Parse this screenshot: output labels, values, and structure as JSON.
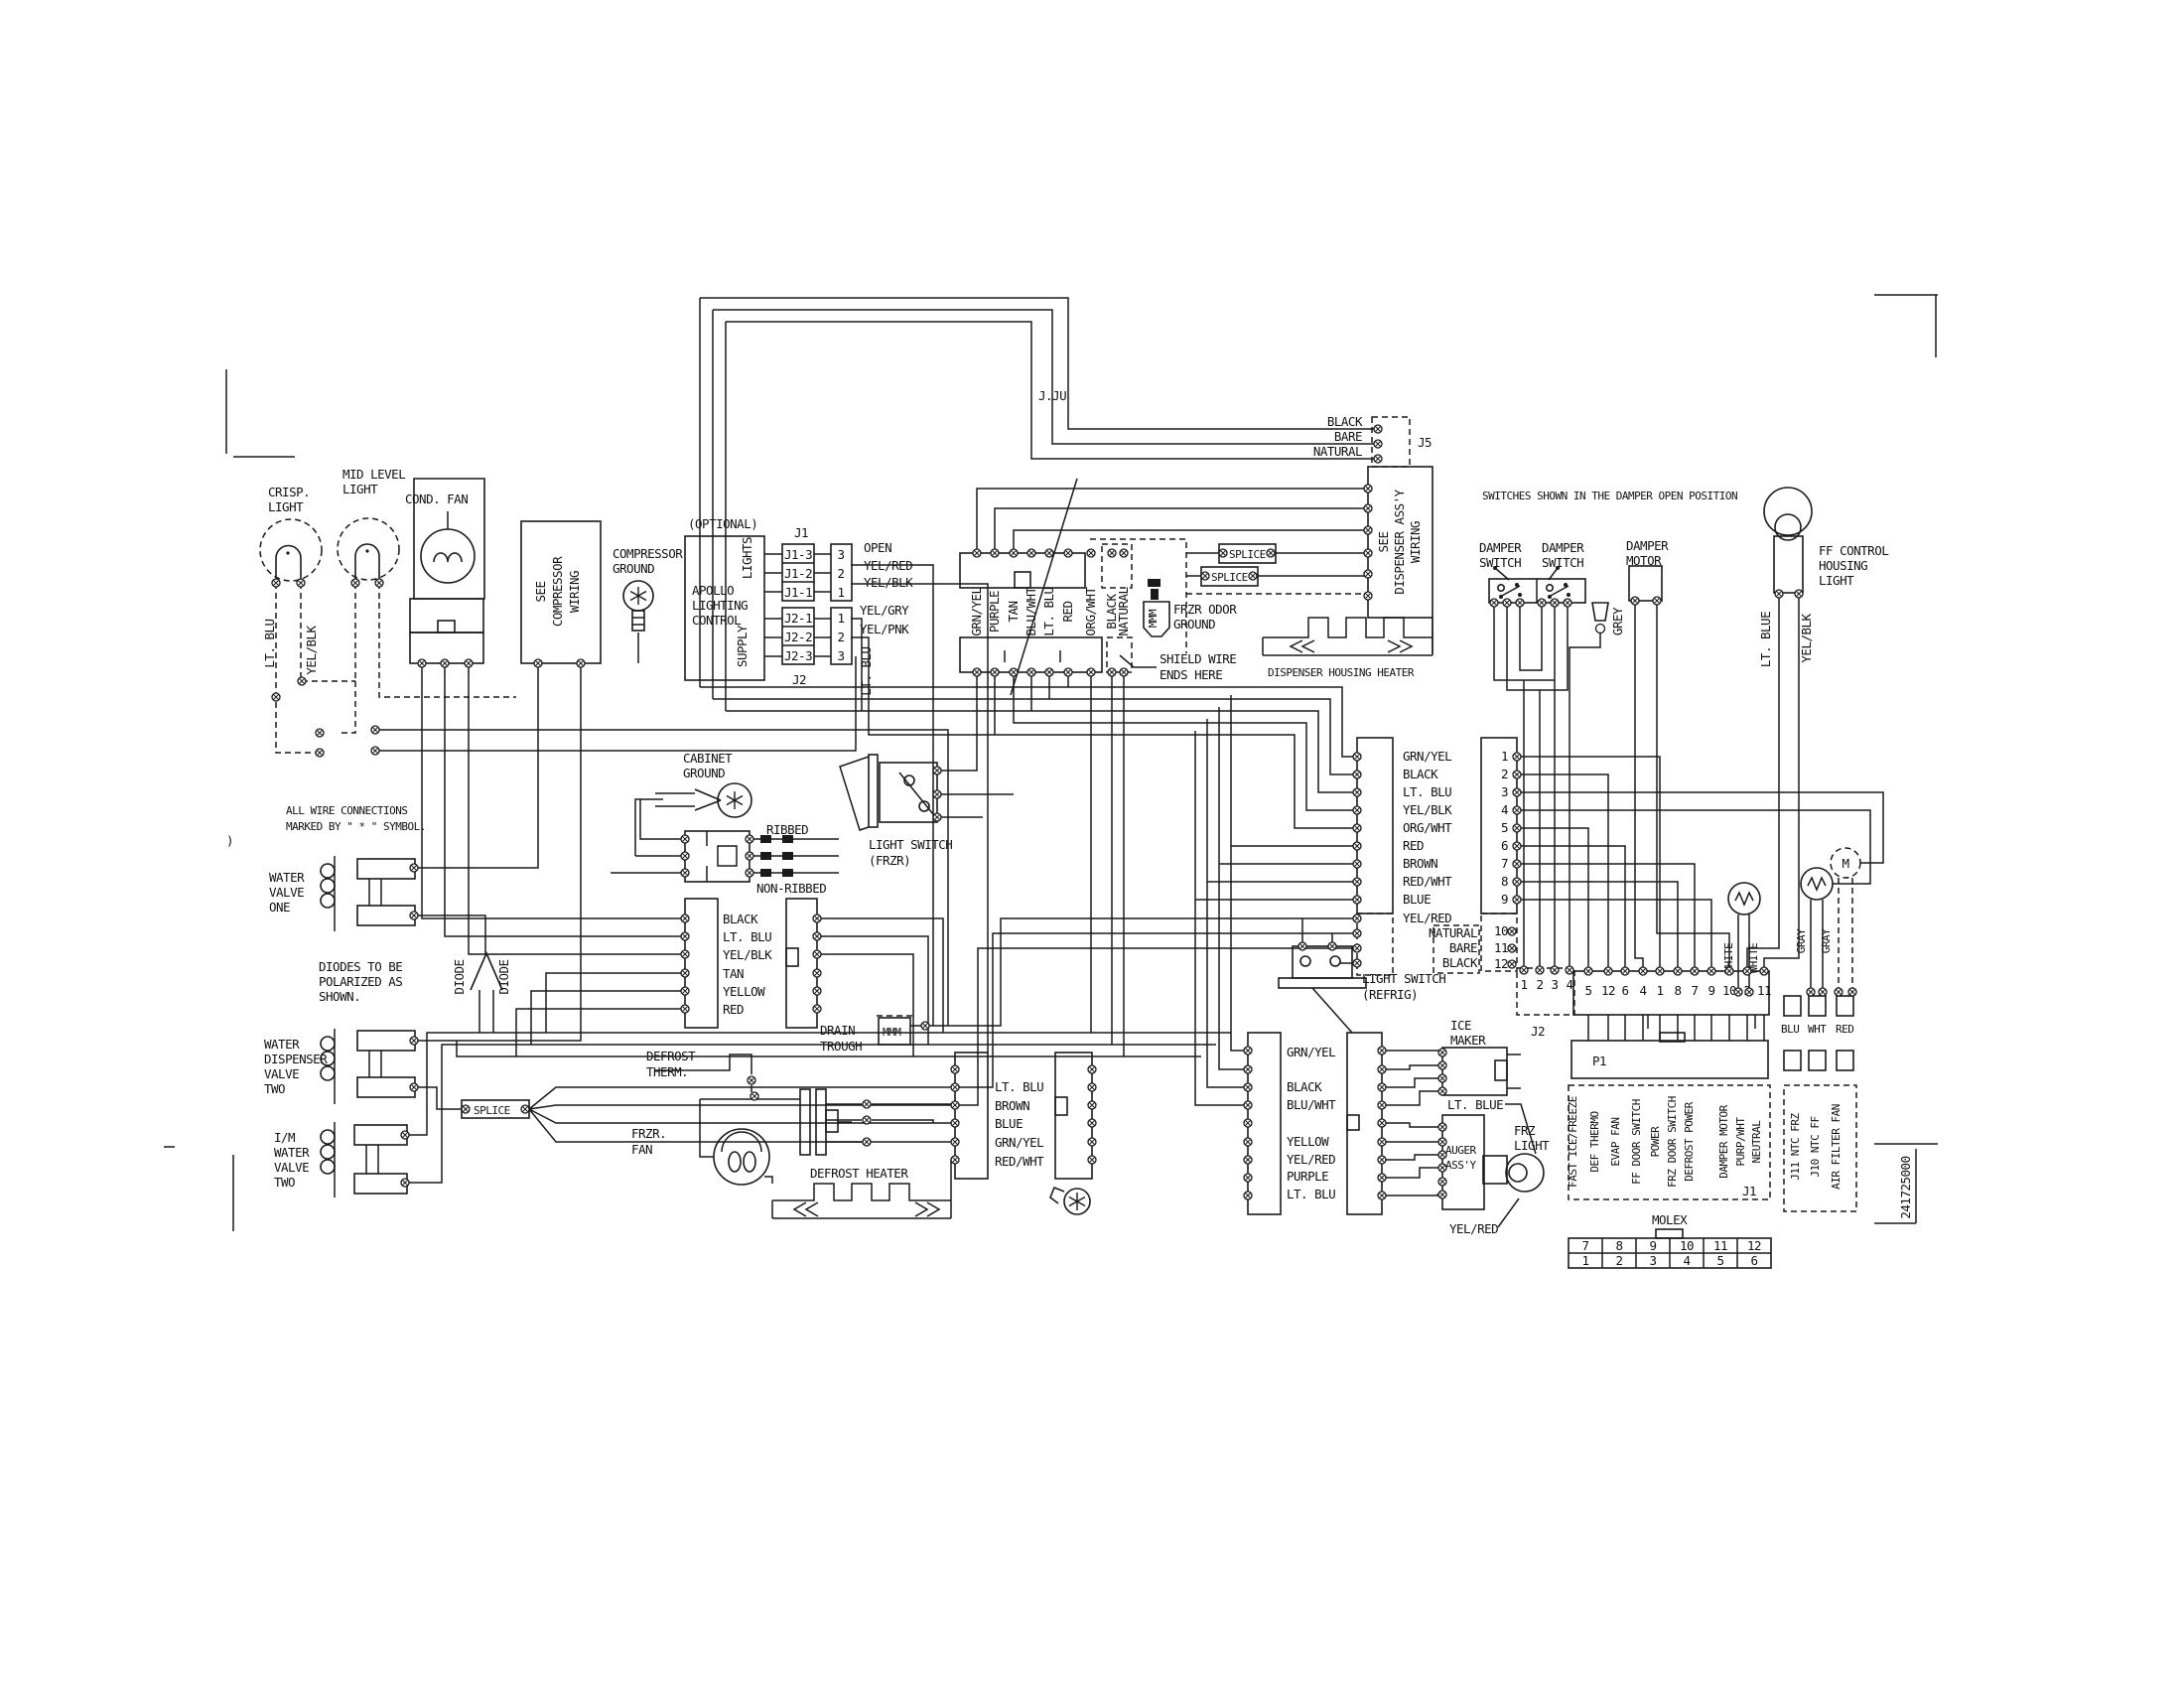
{
  "diagram": {
    "part_number": "241725000",
    "artifact_text": "J.JU",
    "paren": ")",
    "notes": {
      "all_wire_1": "ALL WIRE CONNECTIONS",
      "all_wire_2": "MARKED BY \" * \" SYMBOL.",
      "diodes_1": "DIODES TO BE",
      "diodes_2": "POLARIZED AS",
      "diodes_3": "SHOWN.",
      "switches": "SWITCHES SHOWN IN THE DAMPER OPEN POSITION",
      "shield_1": "SHIELD WIRE",
      "shield_2": "ENDS HERE"
    },
    "components": {
      "crisp_light_1": "CRISP.",
      "crisp_light_2": "LIGHT",
      "mid_level_1": "MID LEVEL",
      "mid_level_2": "LIGHT",
      "cond_fan": "COND. FAN",
      "see_comp_1": "SEE",
      "see_comp_2": "COMPRESSOR",
      "see_comp_3": "WIRING",
      "comp_gnd_1": "COMPRESSOR",
      "comp_gnd_2": "GROUND",
      "optional": "(OPTIONAL)",
      "apollo_1": "APOLLO",
      "apollo_2": "LIGHTING",
      "apollo_3": "CONTROL",
      "lights": "LIGHTS",
      "supply": "SUPPLY",
      "j1": "J1",
      "j2": "J2",
      "cabinet_gnd_1": "CABINET",
      "cabinet_gnd_2": "GROUND",
      "ribbed": "RIBBED",
      "non_ribbed": "NON-RIBBED",
      "ls_frzr_1": "LIGHT SWITCH",
      "ls_frzr_2": "(FRZR)",
      "drain_1": "DRAIN",
      "drain_2": "TROUGH",
      "def_therm_1": "DEFROST",
      "def_therm_2": "THERM.",
      "frzr_fan_1": "FRZR.",
      "frzr_fan_2": "FAN",
      "defrost_heater": "DEFROST HEATER",
      "frzr_odor_1": "FRZR ODOR",
      "frzr_odor_2": "GROUND",
      "mmm": "MMM",
      "water_valve_one_1": "WATER",
      "water_valve_one_2": "VALVE",
      "water_valve_one_3": "ONE",
      "wd_valve_1": "WATER",
      "wd_valve_2": "DISPENSER",
      "wd_valve_3": "VALVE",
      "wd_valve_4": "TWO",
      "im_valve_1": "I/M",
      "im_valve_2": "WATER",
      "im_valve_3": "VALVE",
      "im_valve_4": "TWO",
      "diode": "DIODE",
      "splice": "SPLICE",
      "j5": "J5",
      "see_disp_1": "SEE",
      "see_disp_2": "DISPENSER ASS'Y",
      "see_disp_3": "WIRING",
      "disp_heater": "DISPENSER HOUSING HEATER",
      "damper_sw_1": "DAMPER",
      "damper_sw_2": "SWITCH",
      "damper_mot_1": "DAMPER",
      "damper_mot_2": "MOTOR",
      "grey": "GREY",
      "ff_light_1": "FF CONTROL",
      "ff_light_2": "HOUSING",
      "ff_light_3": "LIGHT",
      "ls_refrig_1": "LIGHT SWITCH",
      "ls_refrig_2": "(REFRIG)",
      "ice_maker_1": "ICE",
      "ice_maker_2": "MAKER",
      "auger_1": "AUGER",
      "auger_2": "ASS'Y",
      "frz_light_1": "FRZ",
      "frz_light_2": "LIGHT",
      "p1": "P1",
      "j1_board": "J1",
      "j2_plug": "J2",
      "molex": "MOLEX",
      "motor_m": "M"
    },
    "wire_labels": {
      "lt_blu_v": "LT. BLU",
      "yel_blk_v": "YEL/BLK",
      "open": "OPEN",
      "yel_red": "YEL/RED",
      "yel_blk": "YEL/BLK",
      "yel_gry": "YEL/GRY",
      "yel_pnk": "YEL/PNK",
      "lt_blu_v2": "LT. BLU",
      "j5_1": "BLACK",
      "j5_2": "BARE",
      "j5_3": "NATURAL",
      "lt_blue_ff": "LT. BLUE",
      "yel_blk_ff": "YEL/BLK",
      "lt_blue_im": "LT. BLUE",
      "yel_red_im": "YEL/RED",
      "white_1": "WHITE",
      "white_2": "WHITE",
      "gray_1": "GRAY",
      "gray_2": "GRAY"
    },
    "lists": {
      "j1_pins": [
        "J1-3",
        "J1-2",
        "J1-1"
      ],
      "j1_plug": [
        "3",
        "2",
        "1"
      ],
      "j2_pins": [
        "J2-1",
        "J2-2",
        "J2-3"
      ],
      "j2_plug": [
        "1",
        "2",
        "3"
      ],
      "harness": [
        "GRN/YEL",
        "PURPLE",
        "TAN",
        "BLU/WHT",
        "LT. BLU",
        "RED",
        "ORG/WHT",
        "BLACK",
        "NATURAL"
      ],
      "mid_conn": [
        "BLACK",
        "LT. BLU",
        "YEL/BLK",
        "TAN",
        "YELLOW",
        "RED"
      ],
      "door": [
        "GRN/YEL",
        "BLACK",
        "LT. BLU",
        "YEL/BLK",
        "ORG/WHT",
        "RED",
        "BROWN",
        "RED/WHT",
        "BLUE",
        "YEL/RED",
        "NATURAL",
        "BARE",
        "BLACK"
      ],
      "door_pins": [
        "1",
        "2",
        "3",
        "4",
        "5",
        "6",
        "7",
        "8",
        "9",
        "10",
        "11",
        "12"
      ],
      "board_pins": [
        "5",
        "12",
        "6",
        "4",
        "1",
        "8",
        "7",
        "9",
        "10",
        "2",
        "11"
      ],
      "j2_plug_pins": [
        "1",
        "2",
        "3",
        "4"
      ],
      "defrost_conn": [
        "LT. BLU",
        "BROWN",
        "BLUE",
        "GRN/YEL",
        "RED/WHT"
      ],
      "ice_conn": [
        "GRN/YEL",
        "BLACK",
        "BLU/WHT",
        "YELLOW",
        "YEL/RED",
        "PURPLE",
        "LT. BLU"
      ],
      "j1_signals": [
        "FAST ICE/FREEZE",
        "DEF THERMO",
        "EVAP FAN",
        "FF DOOR SWITCH",
        "POWER",
        "FRZ DOOR SWITCH",
        "DEFROST POWER",
        "DAMPER MOTOR",
        "PURP/WHT",
        "NEUTRAL"
      ],
      "ntc": [
        "J11 NTC FRZ",
        "J10 NTC FF",
        "AIR FILTER FAN"
      ],
      "ntc_colors": [
        "BLU",
        "WHT",
        "RED"
      ],
      "molex_top": [
        "7",
        "8",
        "9",
        "10",
        "11",
        "12"
      ],
      "molex_bottom": [
        "1",
        "2",
        "3",
        "4",
        "5",
        "6"
      ]
    }
  }
}
